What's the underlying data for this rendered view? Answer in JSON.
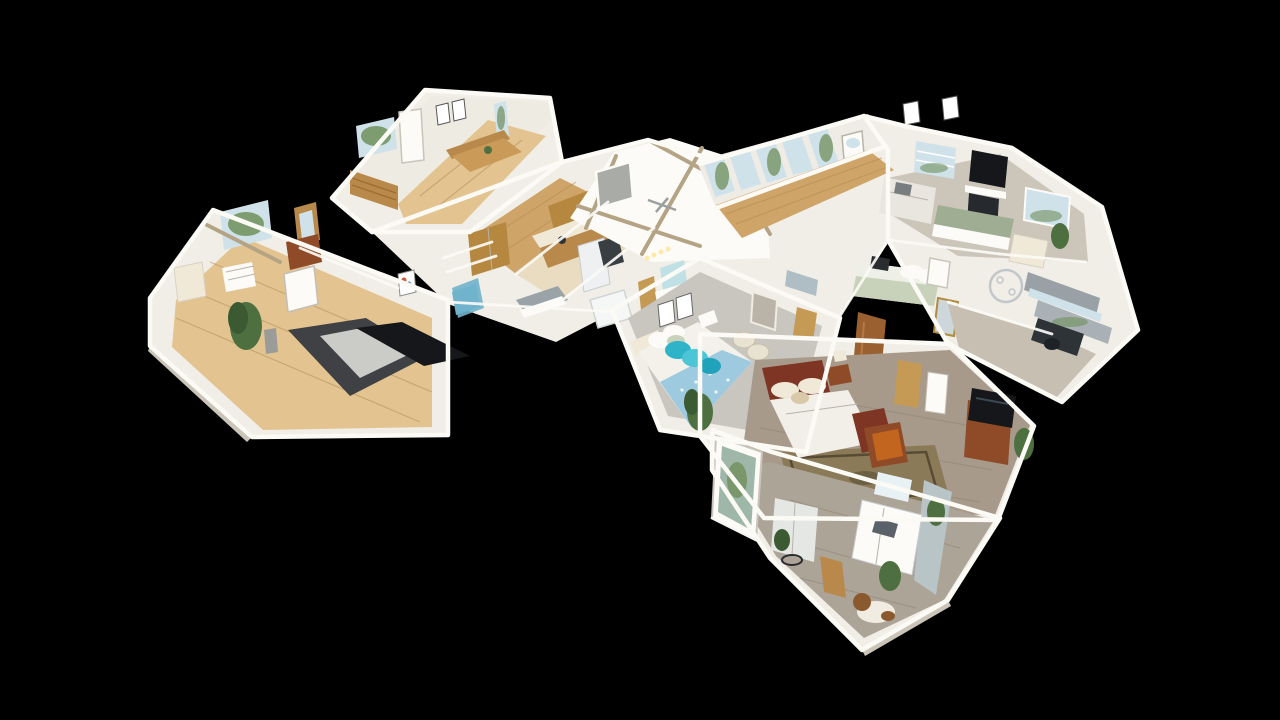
{
  "viewer": {
    "mode": "dollhouse-3d-view",
    "description": "Cutaway dollhouse view of a single-story furnished home seen from above at an angle, floating on a black background. No UI chrome, text or controls are visible.",
    "background": "#000000"
  },
  "scene": {
    "rooms": [
      {
        "name": "dining-nook",
        "features": [
          "wood dining table with bench",
          "white door",
          "framed art pair",
          "garden window"
        ]
      },
      {
        "name": "left-bedroom",
        "features": [
          "dark gray bed",
          "black rug",
          "potted plant",
          "arched-mirror dresser",
          "garden window",
          "wicker chair"
        ]
      },
      {
        "name": "kitchen",
        "features": [
          "oak cabinets",
          "white fridge",
          "dark range",
          "island"
        ]
      },
      {
        "name": "great-room",
        "features": [
          "vaulted white ceiling",
          "exposed beams",
          "framed art",
          "ceiling fan"
        ]
      },
      {
        "name": "entry-foyer",
        "features": [
          "tall window wall",
          "front door with arched glass",
          "wood floor"
        ]
      },
      {
        "name": "living-room",
        "features": [
          "wall TV",
          "fireplace",
          "shuttered windows",
          "white sofa",
          "green console"
        ]
      },
      {
        "name": "guest-bedroom",
        "features": [
          "sage and white bed",
          "chrome wreath decor",
          "gold mirror",
          "rustic barn door"
        ]
      },
      {
        "name": "office",
        "features": [
          "gray roller shades",
          "dark desk",
          "office chair"
        ]
      },
      {
        "name": "blue-bedroom",
        "features": [
          "white and blue bed",
          "teal pillows",
          "woven poufs",
          "framed art",
          "mirror",
          "plant",
          "gray carpet"
        ]
      },
      {
        "name": "master-bedroom",
        "features": [
          "cherry sleigh bed",
          "oriental rug",
          "TV armoire",
          "nightstand lamp",
          "storage chest"
        ]
      },
      {
        "name": "kitchenette-suite",
        "features": [
          "glass entry door",
          "white kitchenette",
          "plants",
          "dog on floor",
          "gray wood floor"
        ]
      }
    ],
    "animals": [
      {
        "name": "dog",
        "colors": [
          "brown",
          "white"
        ]
      }
    ]
  },
  "palette": {
    "bg": "#000000",
    "wall": "#f1eee7",
    "wall-bright": "#fcfbf7",
    "wall-shade": "#ddd8ce",
    "wall-shade2": "#cbc5b9",
    "wood-light": "#e3c491",
    "wood": "#cfa468",
    "wood-dark": "#b9894c",
    "oak": "#b5873f",
    "beige": "#e9dcc0",
    "carpet": "#c9c6c0",
    "carpet-warm": "#ccc5b9",
    "master-floor": "#a79a8b",
    "gray-wood": "#ada498",
    "cherry": "#7e3523",
    "cherry2": "#8f4a28",
    "rust": "#9a6030",
    "orange": "#c2661f",
    "teal": "#2fb3c9",
    "teal2": "#4cc5d6",
    "teal3": "#1fa2ba",
    "blue-spread": "#9ecadf",
    "stair-blue": "#6fb3cc",
    "glass": "#cfe2ea",
    "glass-green": "#6f8f5b",
    "plant": "#4e7040",
    "plant2": "#3c5a32",
    "dark": "#15171a",
    "charcoal": "#3f4144",
    "appliance": "#393e43",
    "rug": "#8a7a58",
    "rug-border": "#584b33",
    "sage": "#c8d2ba",
    "door-tan": "#c49a55",
    "shade-gray": "#9aa1a6",
    "beam": "#b4a485",
    "cream": "#f0e9d8",
    "cut": "#fbfaf5",
    "plank": "#b08a52",
    "plank-gray": "#8f8476"
  }
}
